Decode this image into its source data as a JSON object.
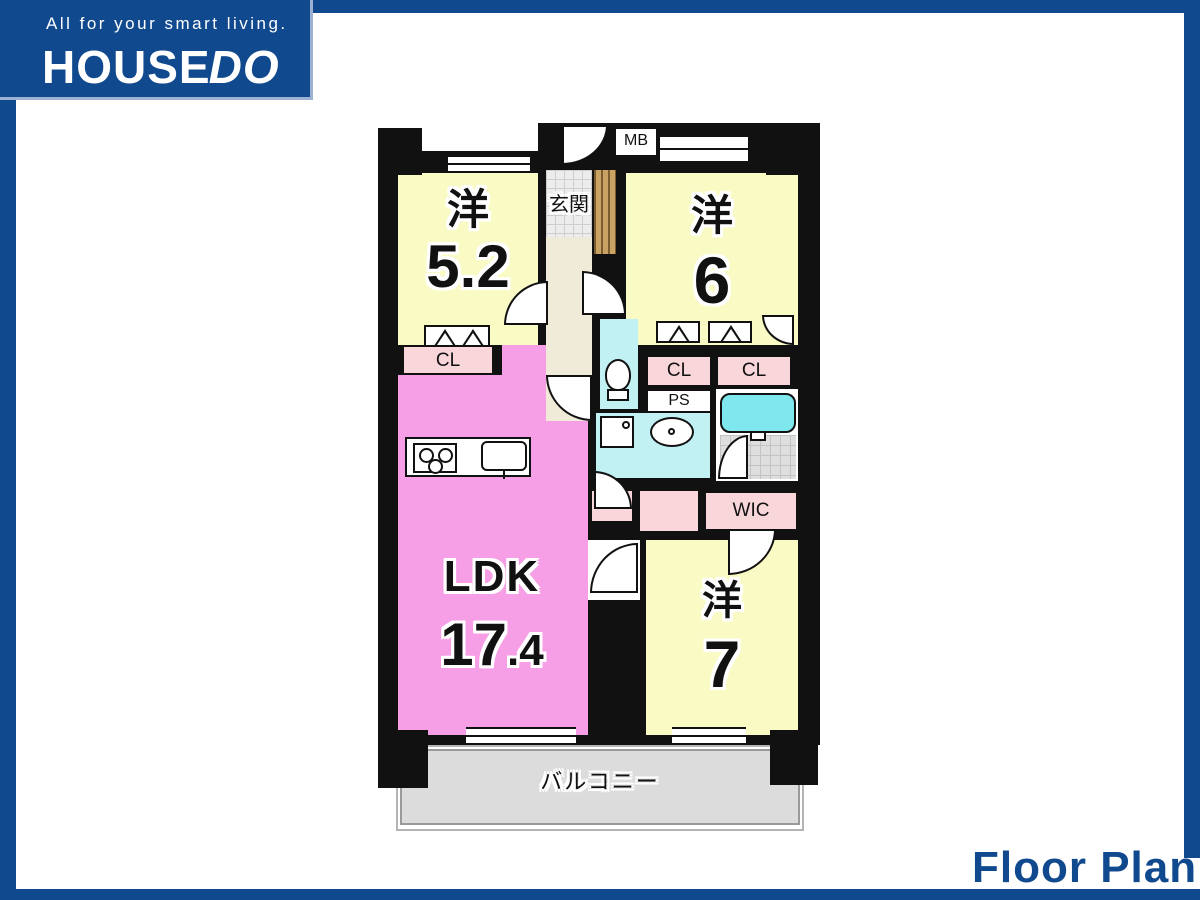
{
  "page": {
    "accent_blue": "#11498e",
    "background": "#ffffff"
  },
  "logo": {
    "tagline": "All for your smart living.",
    "brand_main": "HOUSE",
    "brand_accent": "DO"
  },
  "footer": {
    "title": "Floor Plan"
  },
  "plan": {
    "rooms": {
      "west1": {
        "kind": "洋",
        "size": "5.2"
      },
      "west2": {
        "kind": "洋",
        "size": "6"
      },
      "west3": {
        "kind": "洋",
        "size": "7"
      },
      "ldk": {
        "kind": "LDK",
        "size_int": "17",
        "size_dec": ".4"
      },
      "entrance": "玄関",
      "balcony": "バルコニー"
    },
    "labels": {
      "mb": "MB",
      "ps": "PS",
      "wic": "WIC",
      "cl": "CL"
    },
    "colors": {
      "wall_black": "#111111",
      "room_yellow": "#fafac5",
      "ldk_pink": "#f79fe6",
      "closet_pink": "#f8d6da",
      "wet_cyan": "#c2f1f4",
      "tub_cyan": "#7fe8ef",
      "hall_beige": "#f0ead8",
      "balcony_gray": "#dcdcdc"
    }
  }
}
